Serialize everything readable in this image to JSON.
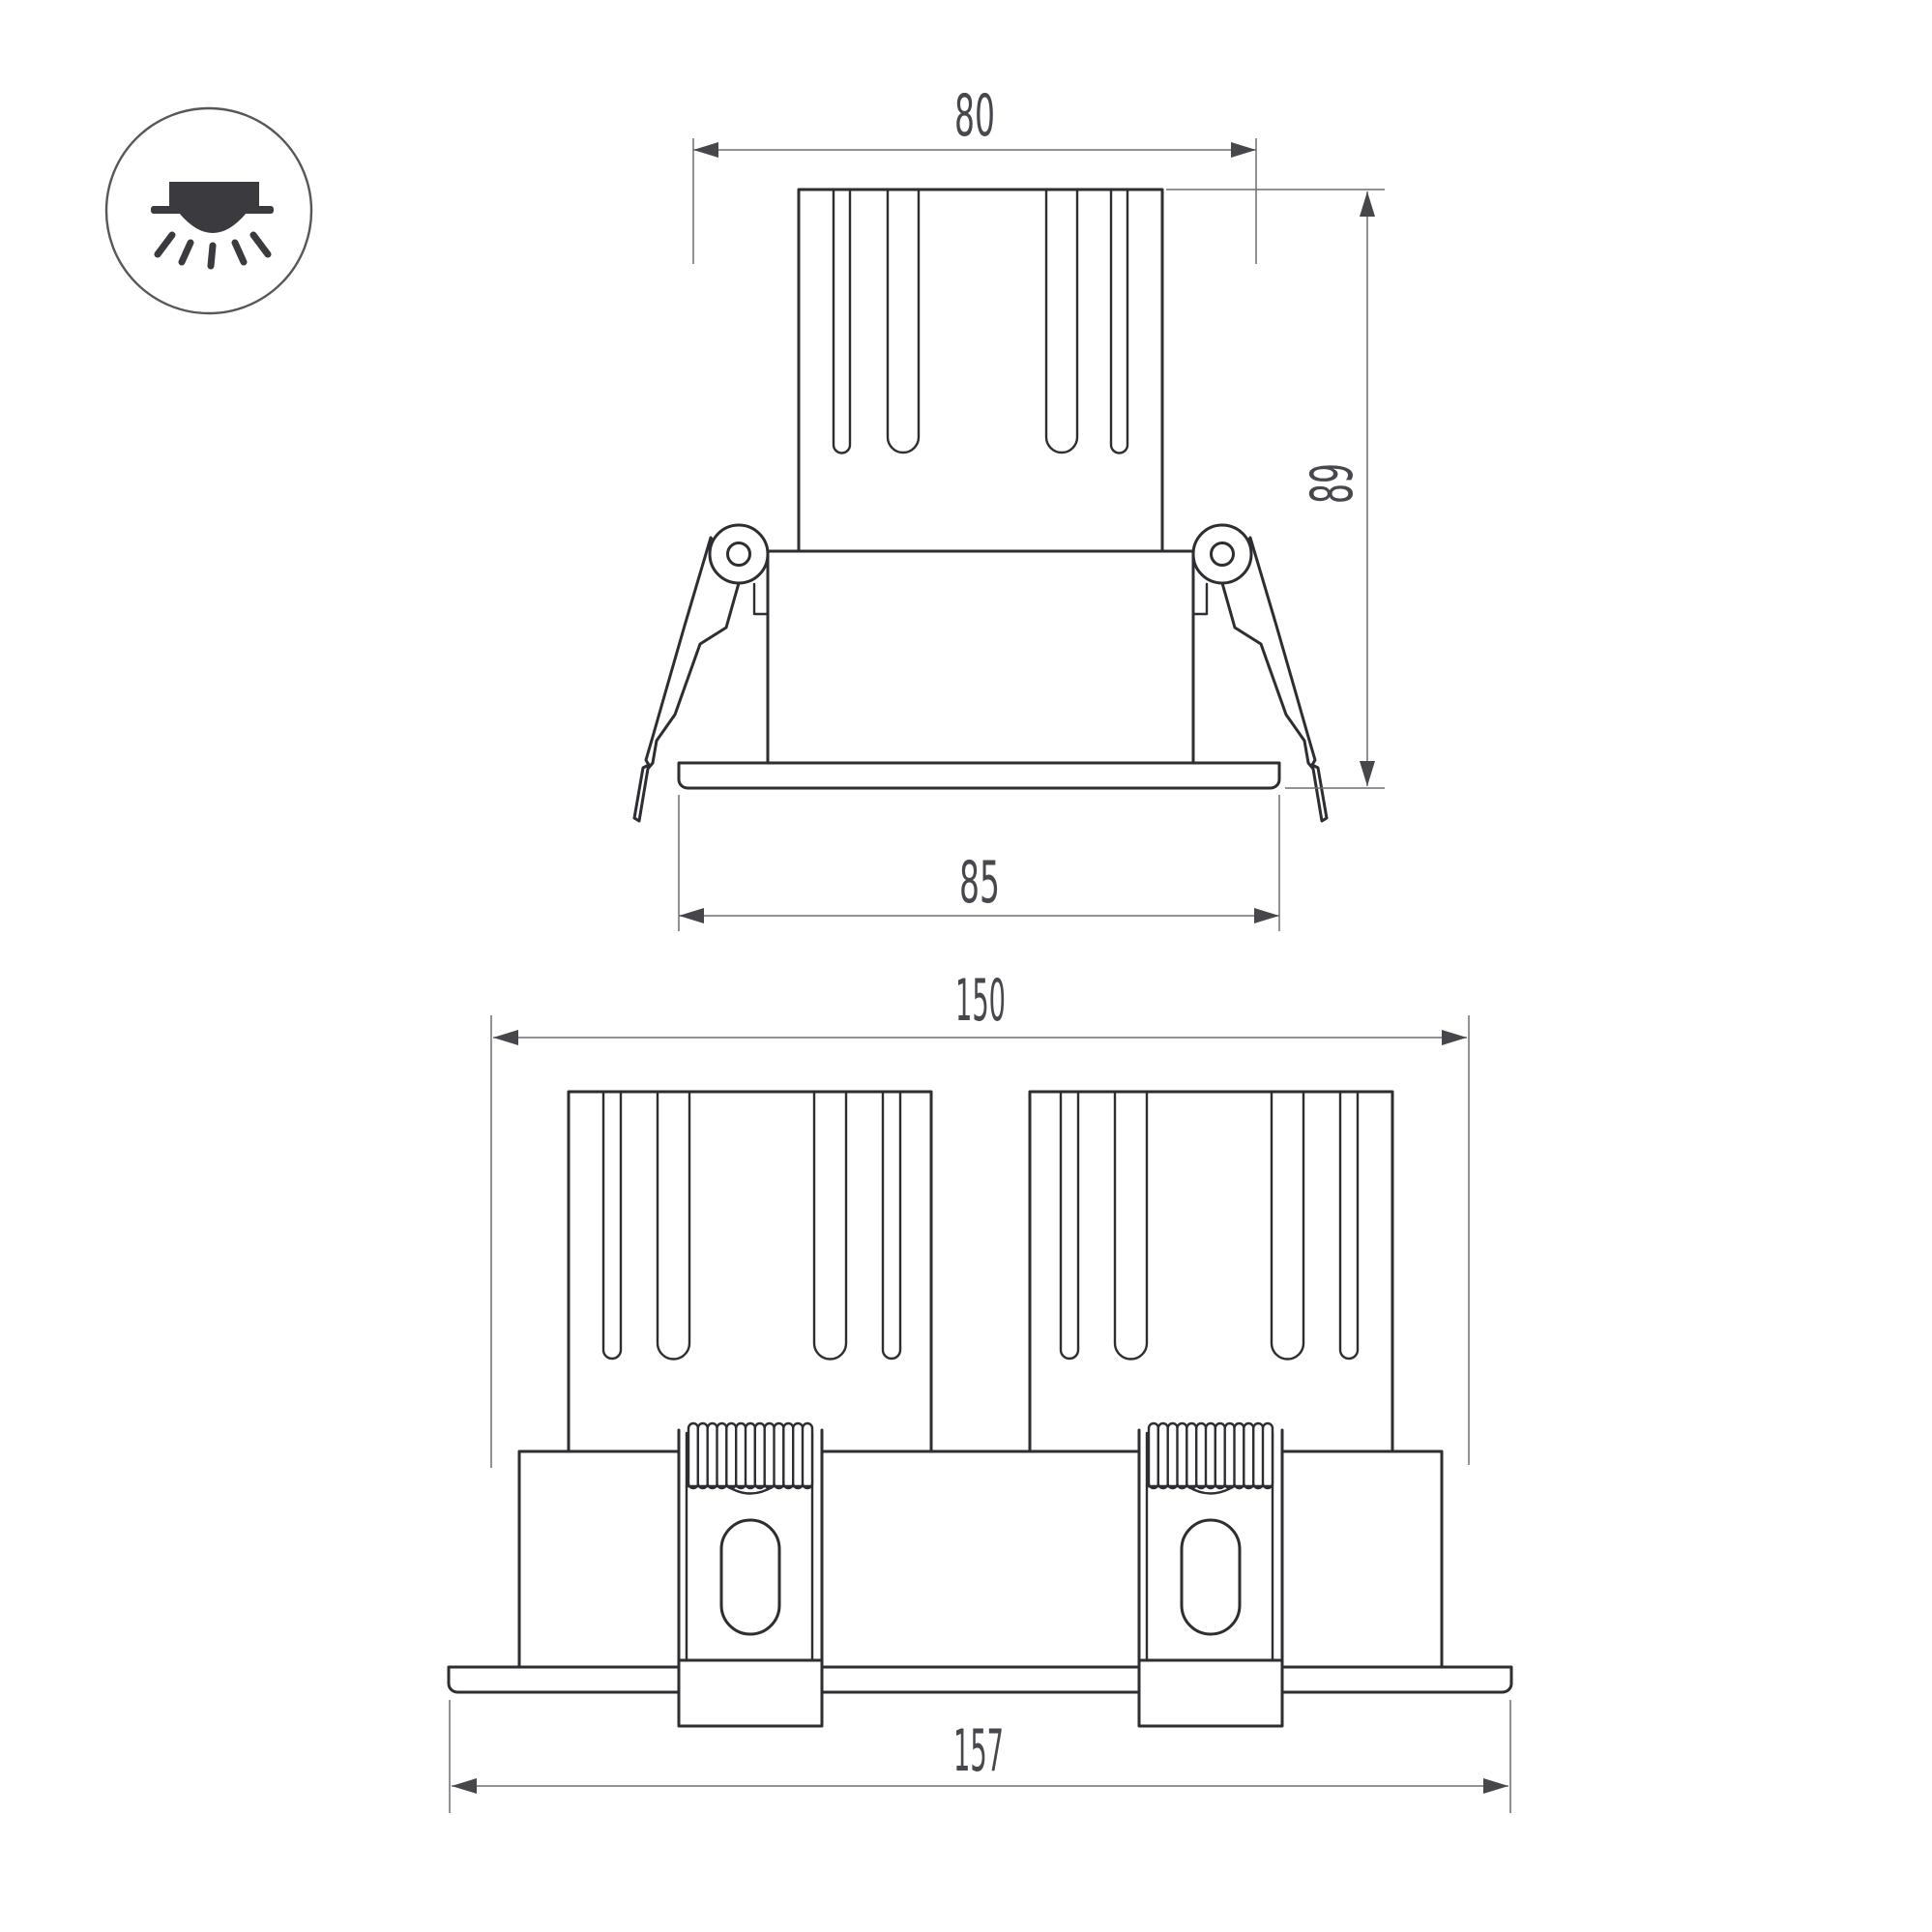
{
  "document": {
    "type": "technical-dimension-drawing",
    "subject": "recessed-downlight-luminaire",
    "background": "#ffffff"
  },
  "legend_icon": {
    "name": "recessed-downlight-icon"
  },
  "front_view": {
    "name": "single-module-front-view",
    "dim_top_width": "80",
    "dim_height": "89",
    "dim_flange_width": "85"
  },
  "double_view": {
    "name": "double-module-front-view",
    "dim_body_width": "150",
    "dim_flange_width": "157"
  },
  "colors": {
    "outline": "#2d2d32",
    "dimension_line": "#6e6e73",
    "arrow": "#46464b",
    "label": "#47474d",
    "icon": "#3a3a3f"
  }
}
